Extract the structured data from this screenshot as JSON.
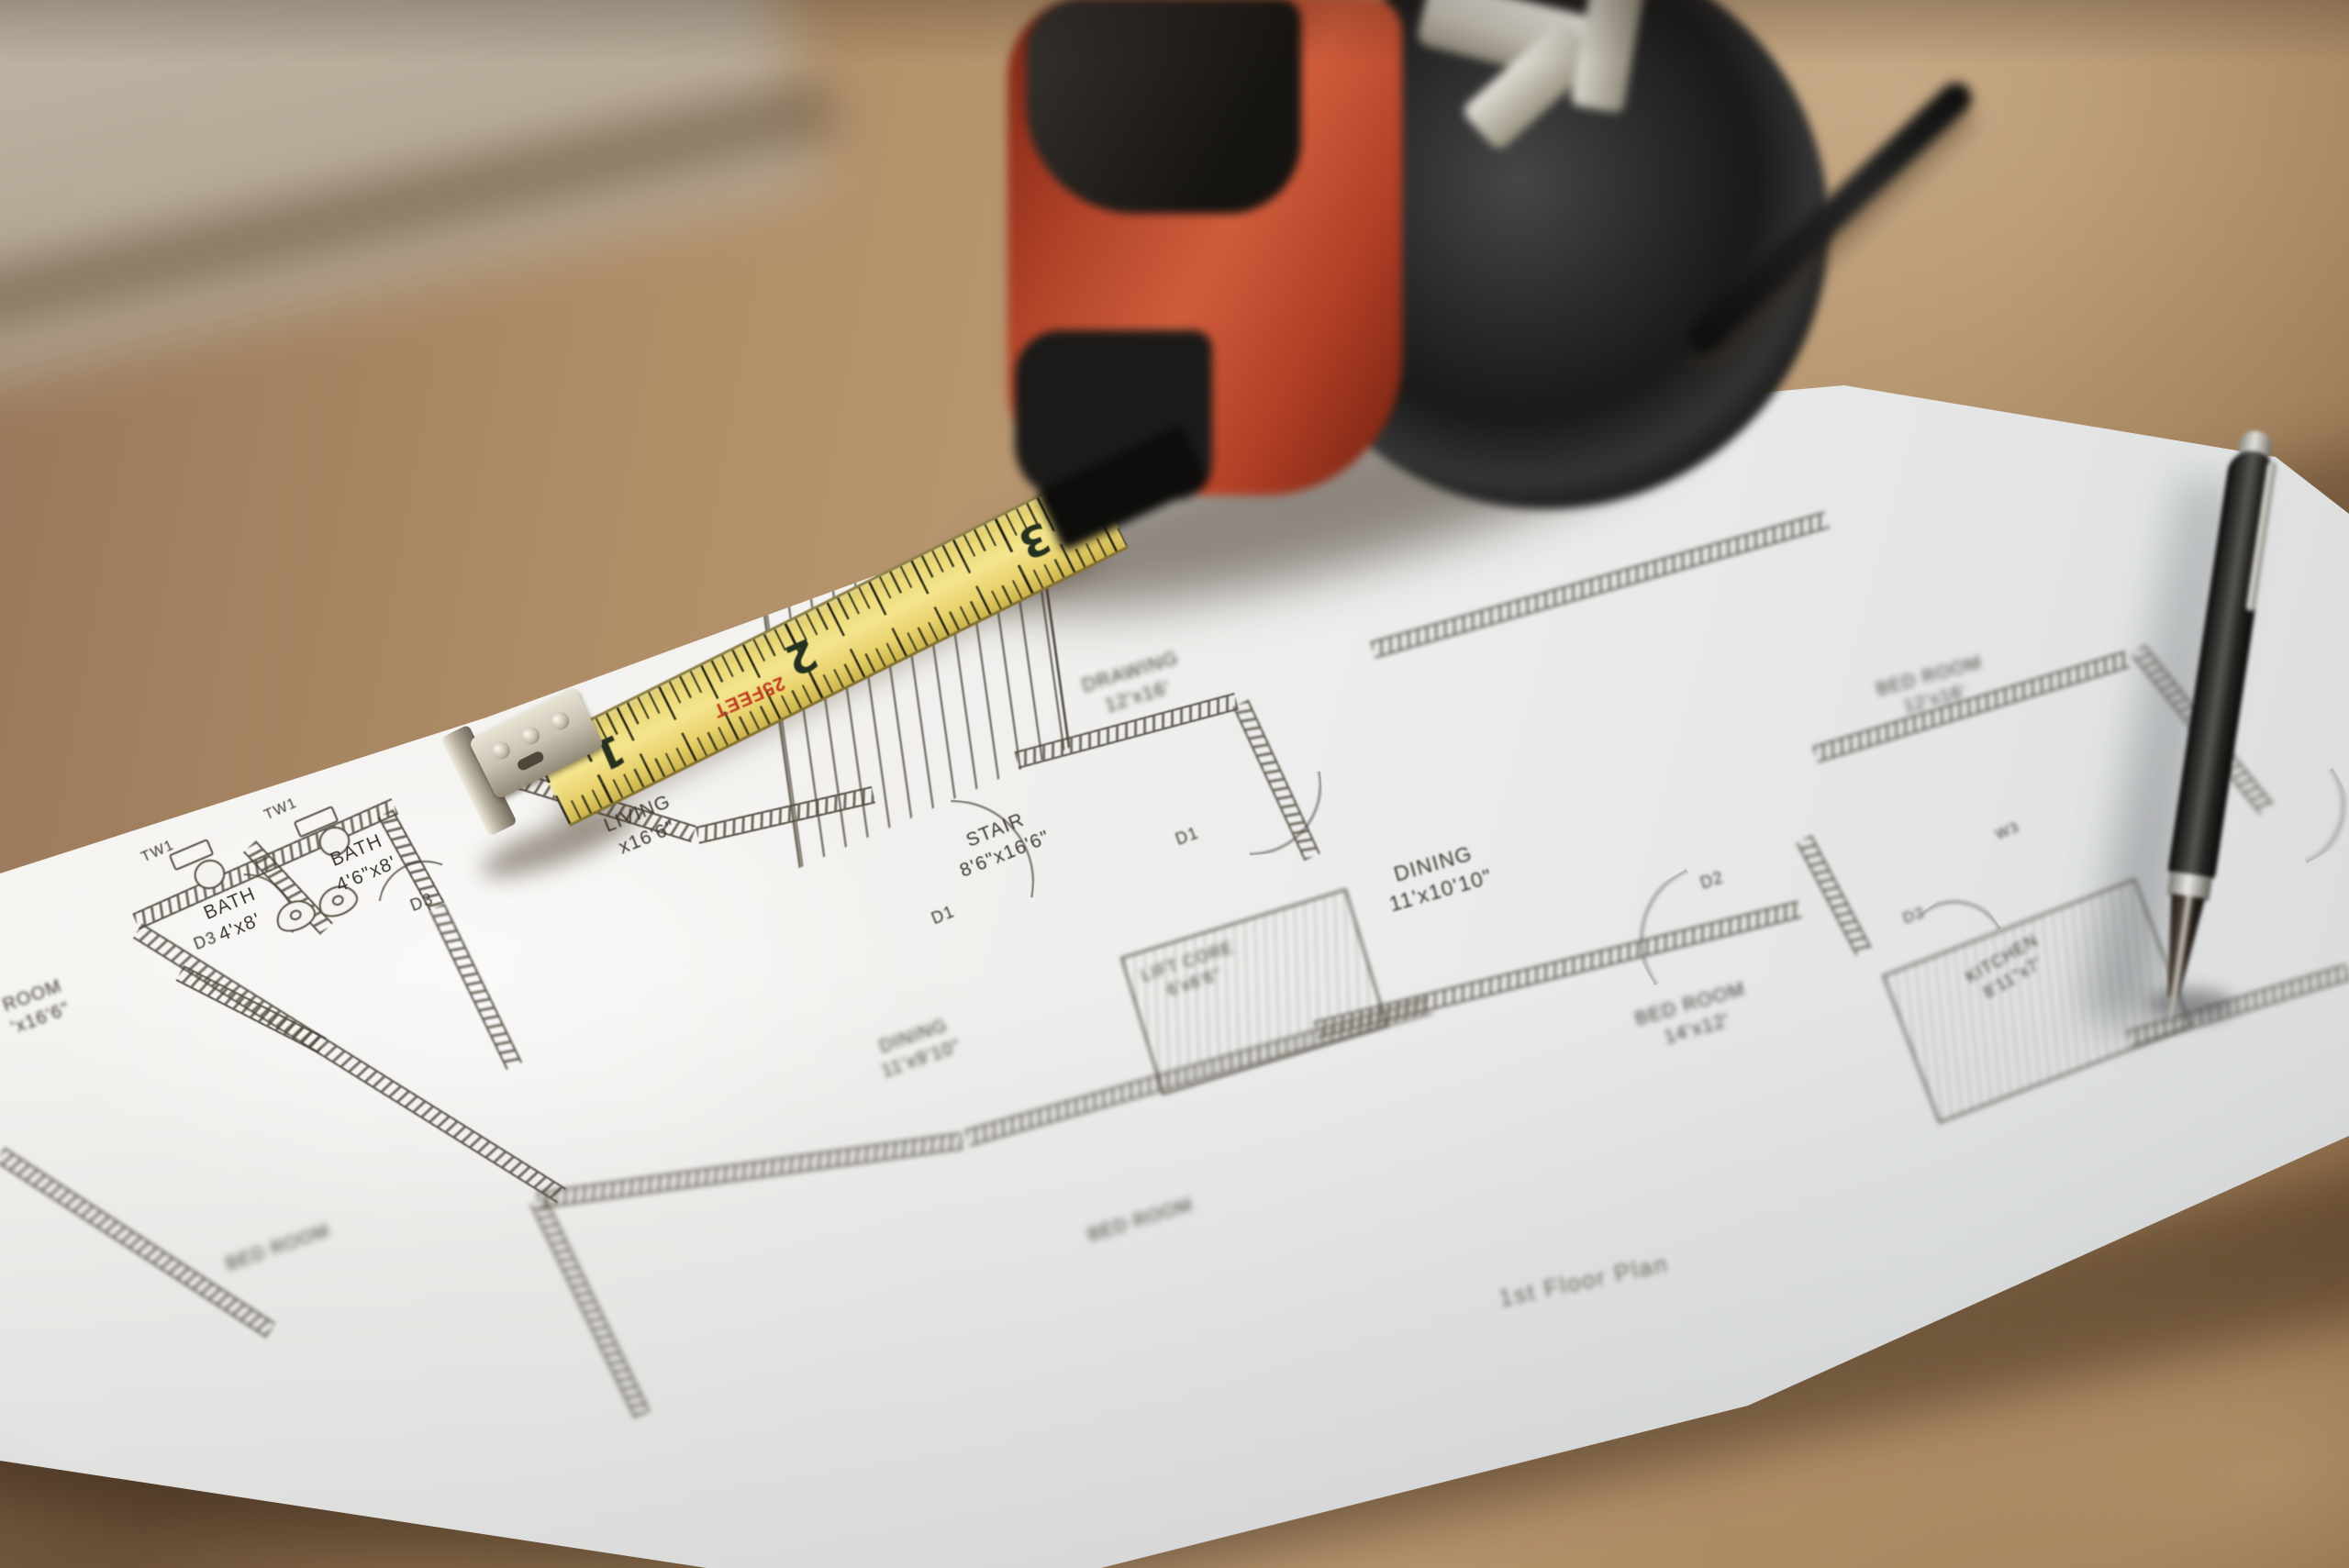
{
  "floor_plan": {
    "title": "1st Floor Plan",
    "rooms": [
      {
        "name": "bath-1",
        "label": "BATH",
        "dims": "4'x8'"
      },
      {
        "name": "bath-2",
        "label": "BATH",
        "dims": "4'6\"x8'"
      },
      {
        "name": "stair",
        "label": "STAIR",
        "dims": "8'6\"x16'6\""
      },
      {
        "name": "lift-core",
        "label": "LIFT CORE",
        "dims": "6'x6'6\""
      },
      {
        "name": "dining",
        "label": "DINING",
        "dims": "11'x10'10\""
      },
      {
        "name": "drawing-room",
        "label": "DRAWING",
        "dims": "12'x16'"
      },
      {
        "name": "bed-room-top-right",
        "label": "BED ROOM",
        "dims": "12'x16'"
      },
      {
        "name": "bed-room-center",
        "label": "BED ROOM",
        "dims": "14'x12'"
      },
      {
        "name": "kitchen",
        "label": "KITCHEN",
        "dims": "8'11\"x7'"
      },
      {
        "name": "living",
        "label": "LIVING",
        "dims": "x16'6\""
      },
      {
        "name": "room-left-edge",
        "label": "ROOM",
        "dims": "'x16'6\""
      },
      {
        "name": "dining-lower",
        "label": "DINING",
        "dims": "11'x9'10\""
      },
      {
        "name": "bed-room-bottom-left",
        "label": "BED ROOM",
        "dims": ""
      },
      {
        "name": "bed-room-bottom-center",
        "label": "BED ROOM",
        "dims": ""
      }
    ],
    "doors": [
      "D1",
      "D1",
      "D2",
      "D2",
      "D3",
      "D3"
    ],
    "windows": [
      "TW1",
      "TW1",
      "W3"
    ]
  },
  "tape_measure": {
    "length_marking": "25FEET",
    "scale_numbers": [
      "1",
      "2",
      "3"
    ]
  },
  "palette": {
    "wood": "#ab8a66",
    "paper": "#f3f2ef",
    "plan_ink": "#4a443c",
    "tape_blade_yellow": "#ecd978",
    "tape_body_red": "#b04228",
    "tape_body_black": "#1a1918",
    "hook_metal": "#c9c2b1",
    "pen_black": "#262421",
    "feet_marking_red": "#bf3a20"
  }
}
